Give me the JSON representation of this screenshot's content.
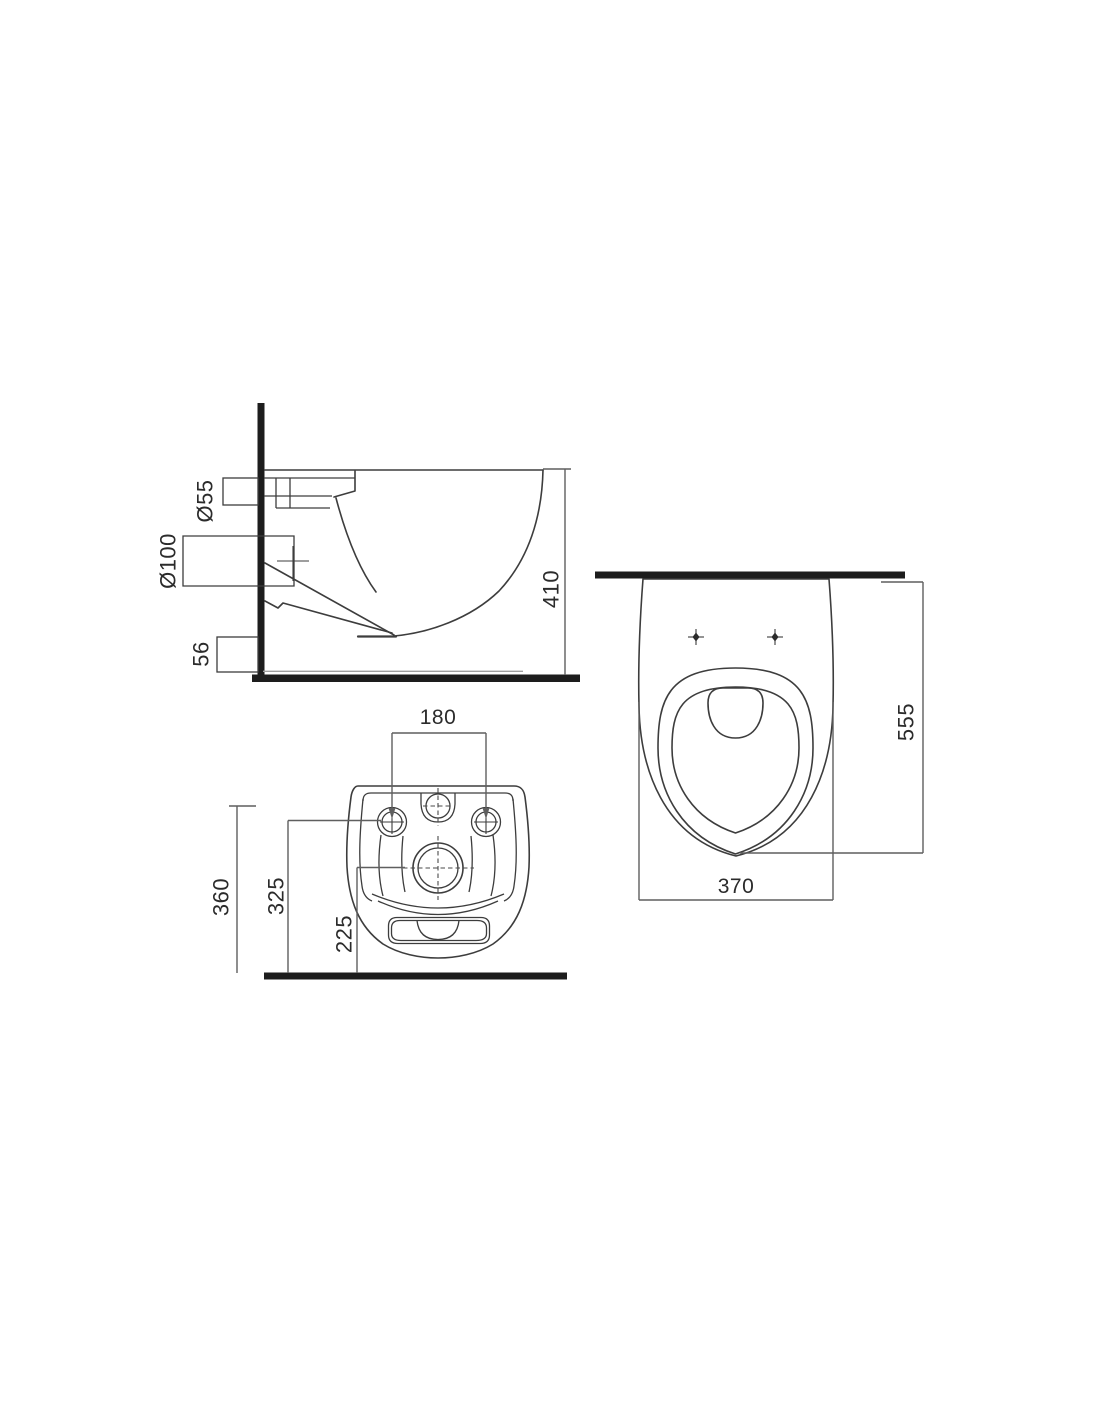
{
  "drawing": {
    "side_view": {
      "outlet_diameter_label": "Ø55",
      "drain_diameter_label": "Ø100",
      "outlet_bottom_height_label": "56",
      "overall_height_label": "410"
    },
    "top_view": {
      "overall_width_label": "370",
      "overall_depth_label": "555"
    },
    "rear_view": {
      "fixing_hole_spacing_label": "180",
      "inlet_center_height_label": "360",
      "fixing_holes_height_label": "325",
      "drain_center_height_label": "225"
    },
    "colors": {
      "background": "#ffffff",
      "outline_line": "#3d3d3d",
      "dimension_line": "#5f5f5f",
      "heavy_wall_floor": "#1d1d1d",
      "text": "#2b2b2b"
    }
  }
}
